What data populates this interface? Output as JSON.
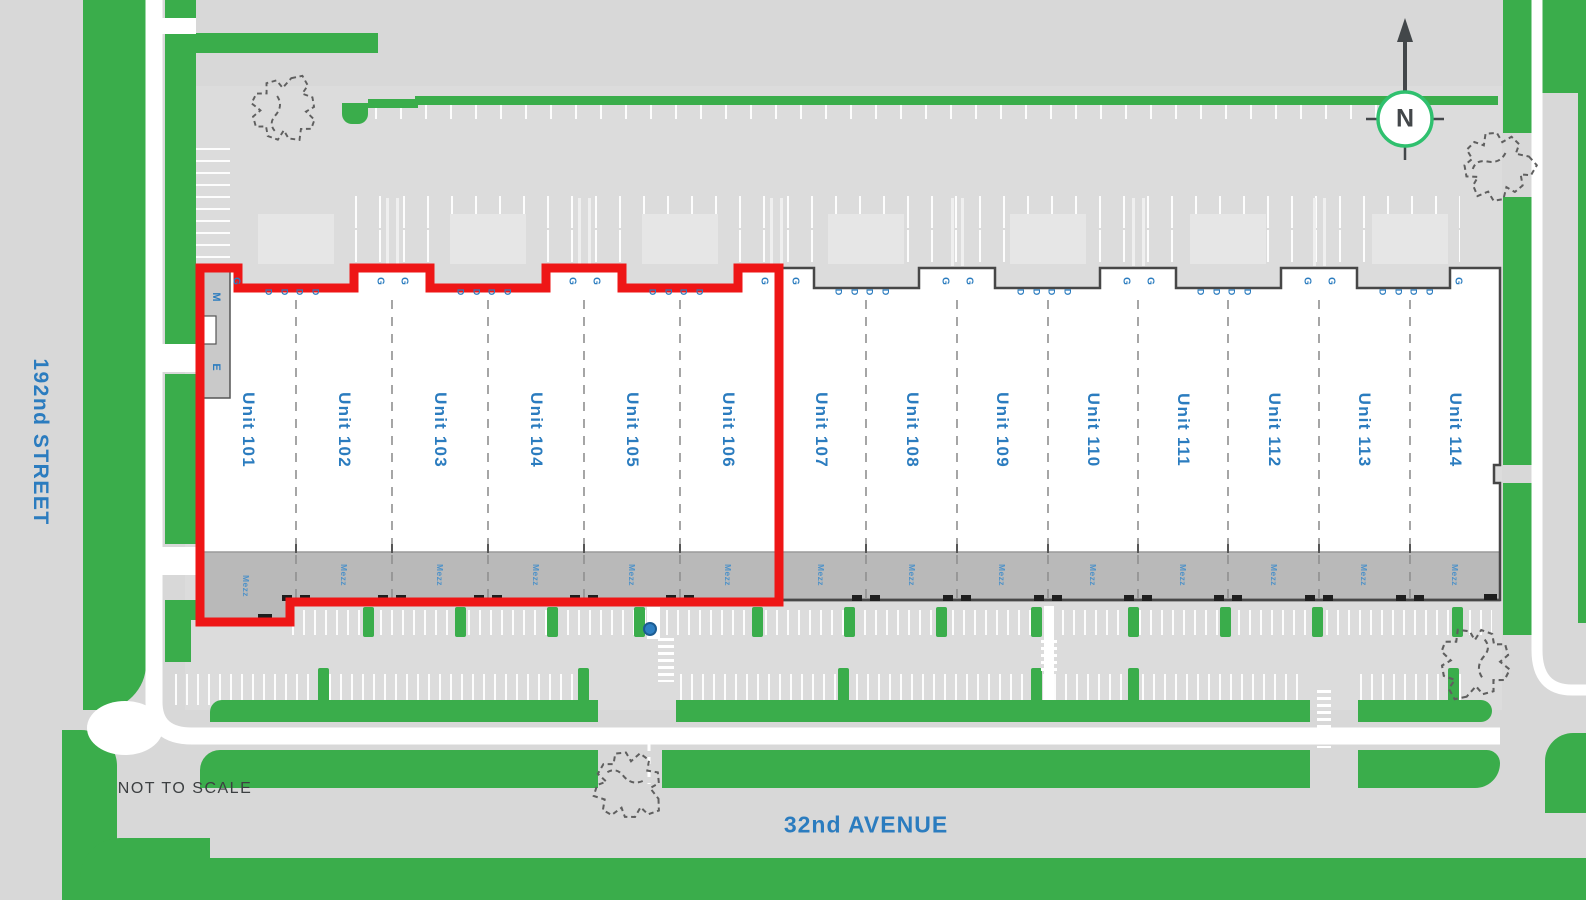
{
  "plan": {
    "scale_note": "NOT TO SCALE",
    "streets": {
      "west": "192nd STREET",
      "south": "32nd AVENUE"
    },
    "compass": {
      "label": "N"
    },
    "building": {
      "garage_door_label": "G",
      "man_door_label": "D",
      "mezzanine_label": "Mezz",
      "rooms": {
        "mechanical": "M",
        "electrical": "E"
      },
      "units": [
        {
          "id": "101",
          "label": "Unit 101",
          "highlighted": true
        },
        {
          "id": "102",
          "label": "Unit 102",
          "highlighted": true
        },
        {
          "id": "103",
          "label": "Unit 103",
          "highlighted": true
        },
        {
          "id": "104",
          "label": "Unit 104",
          "highlighted": true
        },
        {
          "id": "105",
          "label": "Unit 105",
          "highlighted": true
        },
        {
          "id": "106",
          "label": "Unit 106",
          "highlighted": true
        },
        {
          "id": "107",
          "label": "Unit 107",
          "highlighted": false
        },
        {
          "id": "108",
          "label": "Unit 108",
          "highlighted": false
        },
        {
          "id": "109",
          "label": "Unit 109",
          "highlighted": false
        },
        {
          "id": "110",
          "label": "Unit 110",
          "highlighted": false
        },
        {
          "id": "111",
          "label": "Unit 111",
          "highlighted": false
        },
        {
          "id": "112",
          "label": "Unit 112",
          "highlighted": false
        },
        {
          "id": "113",
          "label": "Unit 113",
          "highlighted": false
        },
        {
          "id": "114",
          "label": "Unit 114",
          "highlighted": false
        }
      ]
    },
    "highlight": {
      "outline_color": "#ee1616",
      "units_outlined": "Unit 101 - Unit 106"
    },
    "colors": {
      "landscape_green": "#3aad4b",
      "label_blue": "#2b7cbf",
      "highlight_red": "#ee1616",
      "pavement_gray": "#d8d8d8",
      "mezzanine_gray": "#b9b9b9",
      "compass_ring_green": "#2fc06e"
    }
  }
}
